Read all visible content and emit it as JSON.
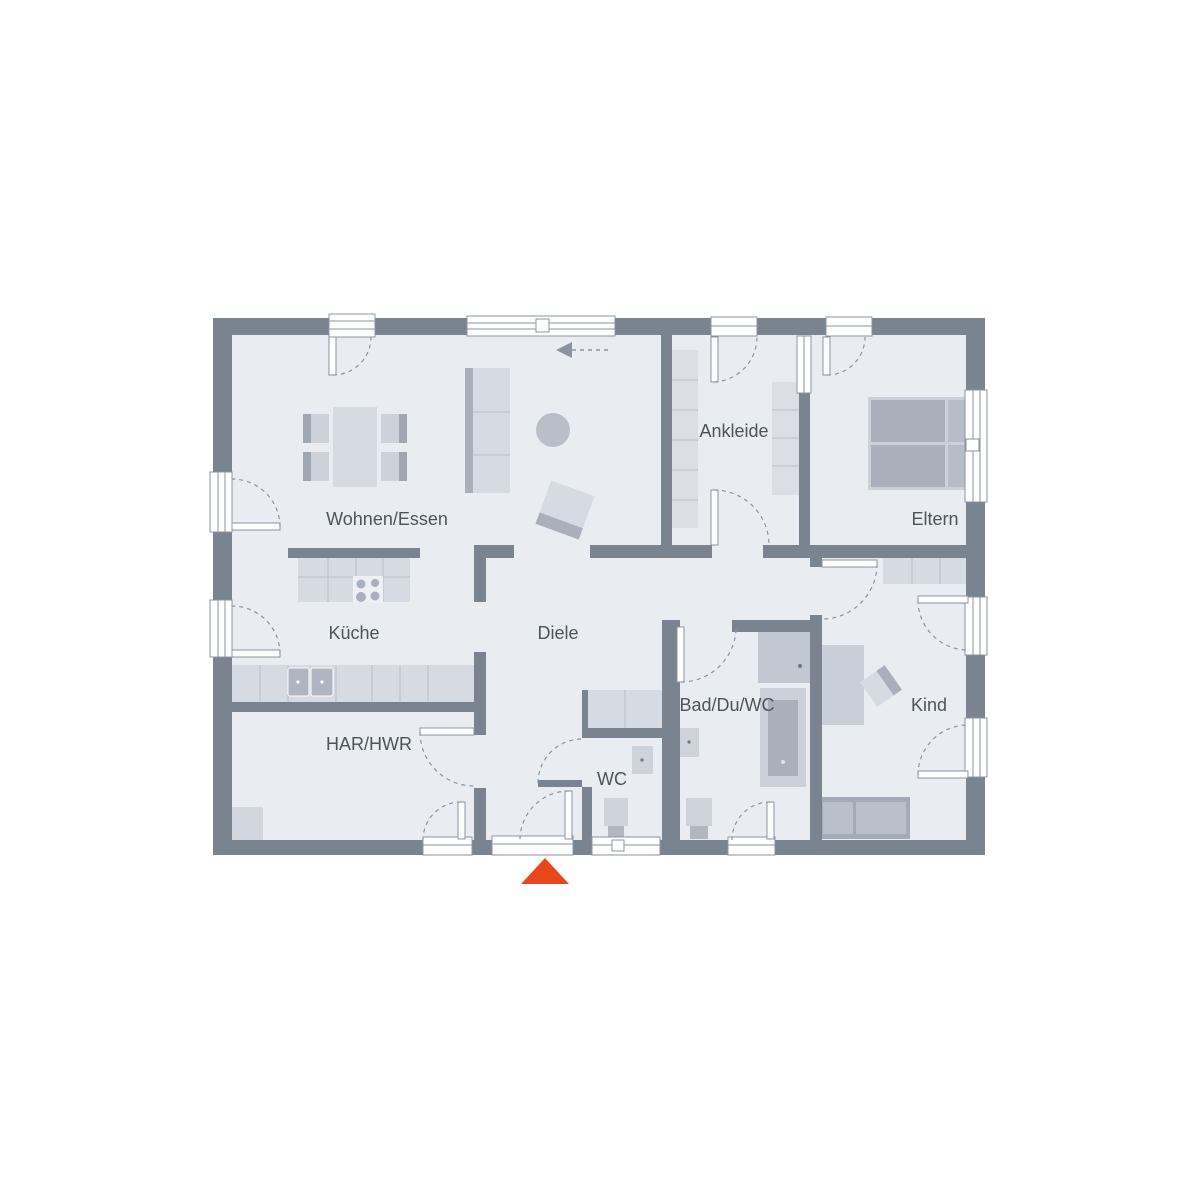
{
  "floorplan": {
    "rooms": [
      {
        "id": "wohnen-essen",
        "label": "Wohnen/Essen"
      },
      {
        "id": "kueche",
        "label": "Küche"
      },
      {
        "id": "diele",
        "label": "Diele"
      },
      {
        "id": "har-hwr",
        "label": "HAR/HWR"
      },
      {
        "id": "wc",
        "label": "WC"
      },
      {
        "id": "ankleide",
        "label": "Ankleide"
      },
      {
        "id": "eltern",
        "label": "Eltern"
      },
      {
        "id": "bad-du-wc",
        "label": "Bad/Du/WC"
      },
      {
        "id": "kind",
        "label": "Kind"
      }
    ],
    "colors": {
      "wall": "#7a8490",
      "floor": "#e9ecf1",
      "entrance_marker": "#e8471e"
    }
  }
}
